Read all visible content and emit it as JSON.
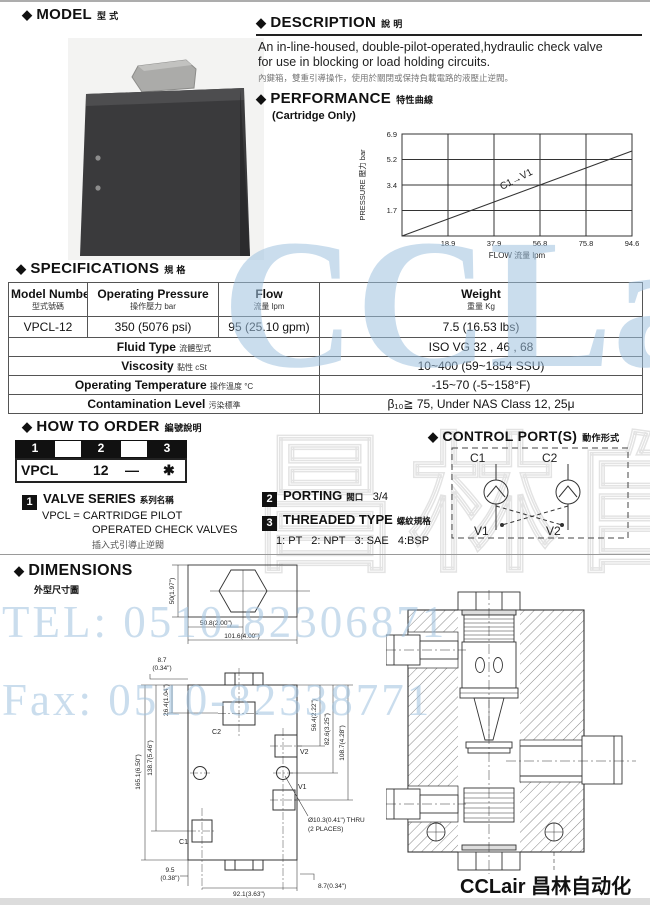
{
  "ui": {
    "diamond": "◆"
  },
  "model": {
    "header": "MODEL",
    "header_cn": "型 式"
  },
  "description": {
    "header": "DESCRIPTION",
    "header_cn": "說 明",
    "line1": "An in-line-housed, double-pilot-operated,hydraulic check valve",
    "line2": "for use in blocking or load holding circuits.",
    "cn": "內鍵箱，雙重引導操作，使用於關閉或保持負載電路的液壓止逆閥。"
  },
  "performance": {
    "header": "PERFORMANCE",
    "header_cn": "特性曲線",
    "subtitle": "(Cartridge Only)"
  },
  "chart_data": {
    "type": "line",
    "series": [
      {
        "name": "C1→V1",
        "x": [
          0,
          94.6
        ],
        "y": [
          0,
          5.6
        ]
      }
    ],
    "curve_label": "C1→V1",
    "xlabel": "FLOW 流量  lpm",
    "ylabel": "PRESSURE 壓力  bar",
    "x_ticks": [
      "18.9",
      "37.9",
      "56.8",
      "75.8",
      "94.6"
    ],
    "y_ticks": [
      "6.9",
      "5.2",
      "3.4",
      "1.7"
    ],
    "xlim": [
      0,
      94.6
    ],
    "ylim": [
      0,
      6.9
    ],
    "grid": true,
    "legend": "inline on curve"
  },
  "specifications": {
    "header": "SPECIFICATIONS",
    "header_cn": "規 格",
    "columns": [
      {
        "en": "Model Number",
        "cn": "型式號碼"
      },
      {
        "en": "Operating Pressure",
        "cn": "操作壓力  bar"
      },
      {
        "en": "Flow",
        "cn": "流量  lpm"
      },
      {
        "en": "Weight",
        "cn": "重量  Kg"
      }
    ],
    "data_row": [
      "VPCL-12",
      "350 (5076 psi)",
      "95 (25.10 gpm)",
      "7.5 (16.53 lbs)"
    ],
    "info_rows": [
      {
        "label_en": "Fluid Type",
        "label_cn": "流體型式",
        "value": "ISO VG 32 , 46 , 68"
      },
      {
        "label_en": "Viscosity",
        "label_cn": "黏性  cSt",
        "value": "10~400 (59~1854 SSU)"
      },
      {
        "label_en": "Operating Temperature",
        "label_cn": "操作溫度 °C",
        "value": "-15~70 (-5~158°F)"
      },
      {
        "label_en": "Contamination Level",
        "label_cn": "污染標準",
        "value": "β₁₀≧ 75, Under NAS Class 12, 25μ"
      }
    ]
  },
  "how_to_order": {
    "header": "HOW TO  ORDER",
    "header_cn": "編號說明",
    "positions": [
      "1",
      "2",
      "3"
    ],
    "code": [
      "VPCL",
      "12",
      "—",
      "✱"
    ]
  },
  "control_ports": {
    "header": "CONTROL PORT(S)",
    "header_cn": "動作形式",
    "c1": "C1",
    "c2": "C2",
    "v1": "V1",
    "v2": "V2"
  },
  "valve_series": {
    "num": "1",
    "title": "VALVE SERIES",
    "title_cn": "系列名稱",
    "line1": "VPCL = CARTRIDGE PILOT",
    "line2": "OPERATED CHECK VALVES",
    "line3_cn": "插入式引導止逆閥"
  },
  "porting": {
    "num": "2",
    "title": "PORTING",
    "title_cn": "閥口",
    "value": "3/4"
  },
  "threaded_type": {
    "num": "3",
    "title": "THREADED TYPE",
    "title_cn": "螺紋規格",
    "options": "1: PT   2: NPT   3: SAE   4:BSP"
  },
  "dimensions": {
    "header": "DIMENSIONS",
    "header_cn": "外型尺寸圖",
    "top_view": {
      "height": "50(1.97\")",
      "half_width": "50.8(2.00\")",
      "full_width": "101.6(4.00\")"
    },
    "front_view": {
      "offset_top_a": "8.7",
      "offset_top_b": "(0.34\")",
      "c2_depth": "26.4(1.04\")",
      "left_h1": "138.7(5.46\")",
      "left_h2": "165.1(6.50\")",
      "right_d1": "56.4(2.22\")",
      "right_d2": "82.6(3.25\")",
      "right_d3": "108.7(4.28\")",
      "bottom_left_a": "9.5",
      "bottom_left_b": "(0.38\")",
      "bottom_width": "92.1(3.63\")",
      "bottom_right": "8.7(0.34\")",
      "thru_a": "Ø10.3(0.41\") THRU",
      "thru_b": "(2 PLACES)",
      "c1": "C1",
      "c2": "C2",
      "v1": "V1",
      "v2": "V2"
    }
  },
  "watermarks": {
    "brand": "CCLair",
    "tel": "TEL: 0510-82306871",
    "fax": "Fax: 0510-82338771",
    "cn_outline": "昌林自动化",
    "blue": "#9fc2e0"
  },
  "footer": {
    "brand": "CCLair 昌林自动化"
  }
}
